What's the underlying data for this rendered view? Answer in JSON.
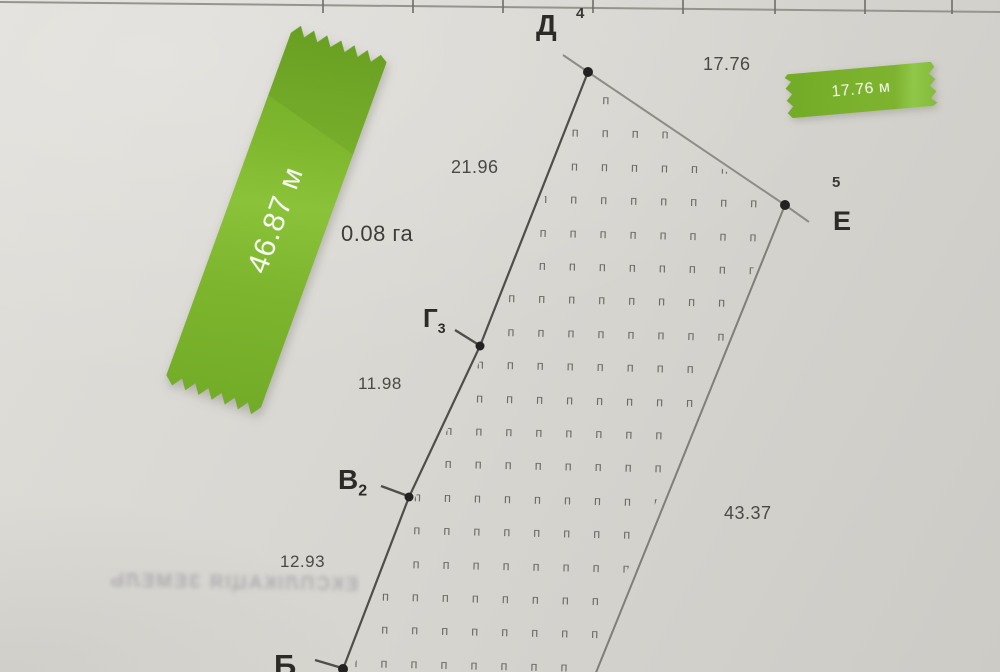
{
  "plan": {
    "area_label": "0.08 га",
    "land_use_symbol": "п",
    "vertices": [
      {
        "id": "D",
        "letter": "Д",
        "point_number": "4"
      },
      {
        "id": "E",
        "letter": "Е",
        "point_number": "5"
      },
      {
        "id": "G3",
        "letter": "Г",
        "index": "3"
      },
      {
        "id": "V2",
        "letter": "В",
        "index": "2"
      },
      {
        "id": "B",
        "letter": "Б"
      }
    ],
    "side_lengths": {
      "d_e": "17.76",
      "d_g3": "21.96",
      "g3_v2": "11.98",
      "v2_b": "12.93",
      "e_south": "43.37"
    }
  },
  "stickers": {
    "left_tape_label": "46.87 м",
    "right_tape_label": "17.76 м"
  },
  "bleed_through_text": "ЕКСПЛІКАЦІЯ ЗЕМЕЛЬ",
  "colors": {
    "tape_green": "#7db32f",
    "paper": "#d8d6d1",
    "ink": "#3a3835",
    "line_dark": "#504e4a",
    "line_light": "#8f8c87"
  }
}
